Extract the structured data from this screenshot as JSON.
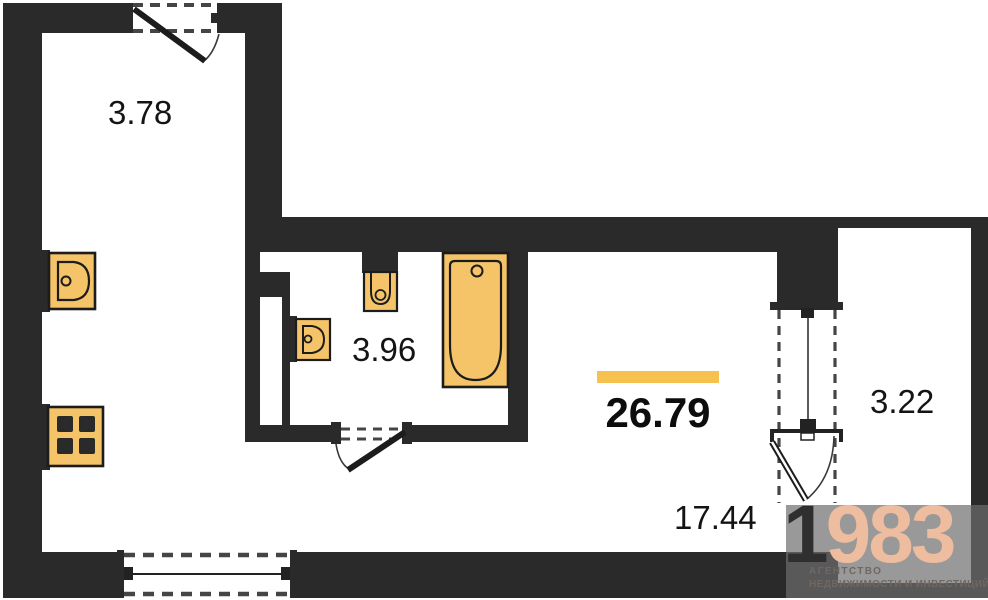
{
  "plan": {
    "rooms": [
      {
        "id": "hall",
        "label": "3.78"
      },
      {
        "id": "bathroom",
        "label": "3.96"
      },
      {
        "id": "living",
        "label": "17.44"
      },
      {
        "id": "balcony",
        "label": "3.22"
      }
    ],
    "total_area": {
      "label": "26.79"
    },
    "fixtures": [
      "kitchen-sink-icon",
      "stove-icon",
      "washbasin-icon",
      "toilet-icon",
      "bathtub-icon"
    ],
    "openings": [
      "entrance-door",
      "bathroom-door",
      "balcony-door",
      "kitchen-window",
      "balcony-window"
    ]
  },
  "watermark": {
    "digit_dark": "1",
    "digits_accent": "983",
    "line1": "АГЕНТСТВО",
    "line2": "НЕДВИЖИМОСТИ И ИНВЕСТИЦИЙ"
  },
  "colors": {
    "bg": "#ffffff",
    "wall": "#2a2a2a",
    "line": "#333333",
    "dash": "#454545",
    "fixture_fill": "#f5c468",
    "fixture_stroke": "#1c1c1c",
    "accent_bar": "#f6c14f",
    "label_text": "#141414",
    "watermark_dark": "#2f2f2f",
    "watermark_accent": "#eebc9f",
    "watermark_text": "#6f6762"
  }
}
